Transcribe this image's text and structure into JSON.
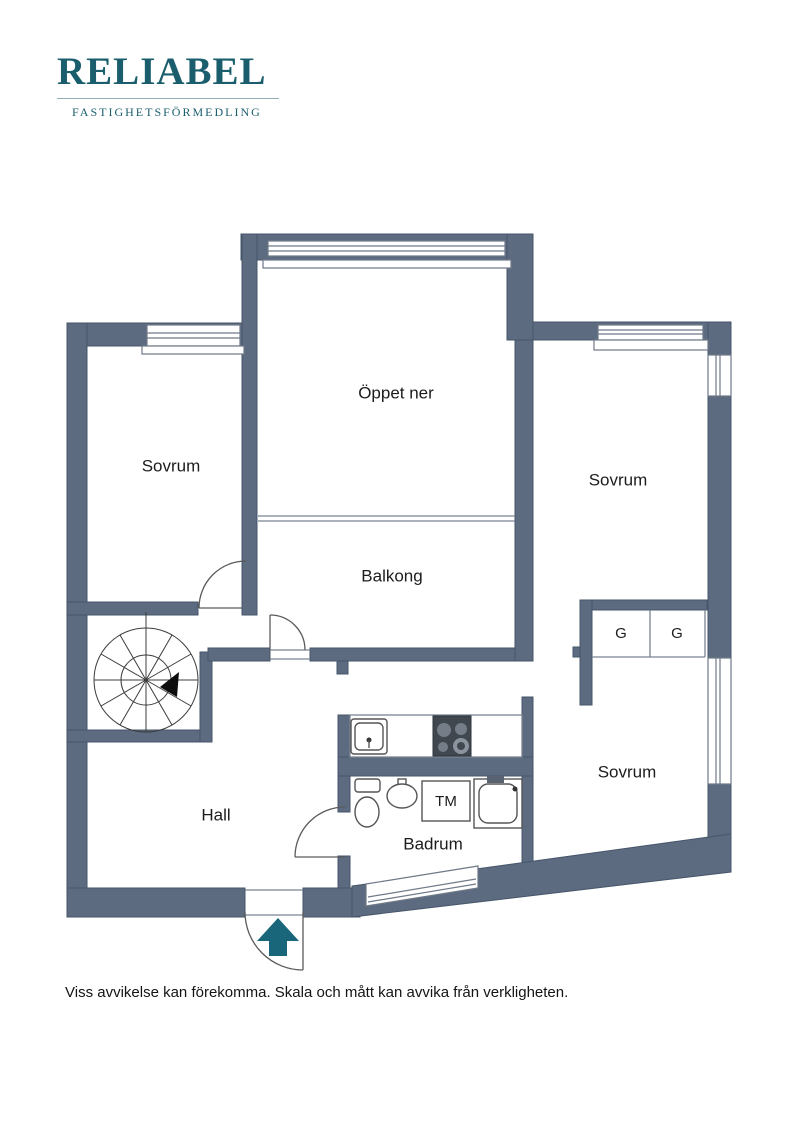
{
  "logo": {
    "brand": "RELIABEL",
    "tagline": "FASTIGHETSFÖRMEDLING"
  },
  "plan": {
    "labels": {
      "oppet_ner": "Öppet ner",
      "sovrum_left": "Sovrum",
      "sovrum_right": "Sovrum",
      "sovrum_bottom": "Sovrum",
      "balkong": "Balkong",
      "hall": "Hall",
      "badrum": "Badrum",
      "tm": "TM",
      "g_left": "G",
      "g_right": "G"
    },
    "colors": {
      "wall": "#5c6b7f",
      "accent": "#1a5e6e"
    }
  },
  "footer": {
    "disclaimer": "Viss avvikelse kan förekomma. Skala och mått kan avvika från verkligheten."
  }
}
